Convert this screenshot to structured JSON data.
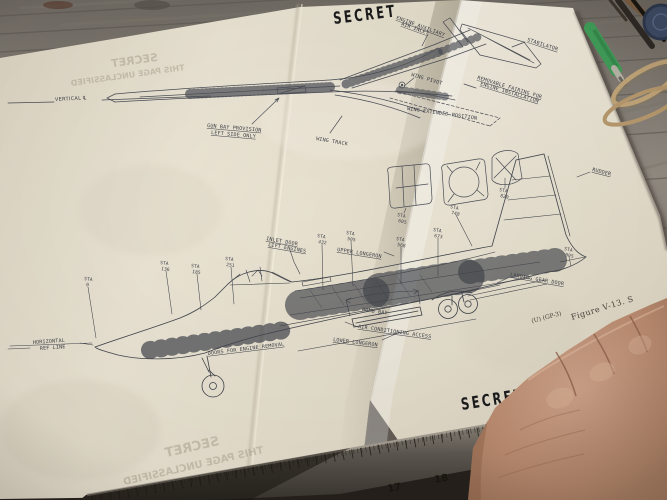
{
  "photo": {
    "stamps": {
      "top": "SECRET",
      "bottom": "SECRET"
    },
    "bleedthrough": {
      "secret": "SECRET",
      "unclassified": "THIS PAGE UNCLASSIFIED"
    },
    "figure": {
      "caption": "Figure V-13. S",
      "code": "(U) (GP-3)"
    },
    "ruler_ticks": [
      "17",
      "18",
      "19"
    ]
  },
  "diagram": {
    "plan": {
      "vertical_cl": "VERTICAL ℄",
      "engine_aux_1": "ENGINE AUXILIARY",
      "engine_aux_2": "AIR INLET",
      "stabilator": "STABILATOR",
      "wing_pivot": "WING PIVOT",
      "wing_extended": "WING EXTENDED POSITION",
      "removable_fairing_1": "REMOVABLE FAIRING FOR",
      "removable_fairing_2": "ENGINE INSTALLATION",
      "gun_bay_1": "GUN BAY PROVISION",
      "gun_bay_2": "LEFT SIDE ONLY",
      "wing_track": "WING TRACK"
    },
    "side": {
      "rudder": "RUDDER",
      "inlet_door_1": "INLET DOOR",
      "inlet_door_2": "LIFT ENGINES",
      "upper_longeron": "UPPER LONGERON",
      "lower_longeron": "LOWER LONGERON",
      "bomb_bay": "BOMB BAY",
      "air_conditioning": "AIR CONDITIONING ACCESS",
      "landing_gear_door": "LANDING GEAR DOOR",
      "doors_engine_removal": "DOORS FOR ENGINE REMOVAL",
      "horizontal_ref_1": "HORIZONTAL",
      "horizontal_ref_2": "REF LINE"
    },
    "stations": [
      {
        "a": "STA",
        "b": "0"
      },
      {
        "a": "STA",
        "b": "136"
      },
      {
        "a": "STA",
        "b": "185"
      },
      {
        "a": "STA",
        "b": "251"
      },
      {
        "a": "STA",
        "b": "432"
      },
      {
        "a": "STA",
        "b": "505"
      },
      {
        "a": "STA",
        "b": "568"
      },
      {
        "a": "STA",
        "b": "605"
      },
      {
        "a": "STA",
        "b": "673"
      },
      {
        "a": "STA",
        "b": "748"
      },
      {
        "a": "STA",
        "b": "820"
      },
      {
        "a": "STA",
        "b": "905"
      }
    ]
  },
  "colors": {
    "paper_left": "#e9e3d3",
    "paper_right": "#f3eee0",
    "ink": "#474a52",
    "stamp": "#1a1a1c",
    "wood": "#8a857c",
    "skin": "#bd8f76",
    "ruler_metal": "#5a554e",
    "pen_green": "#3f9d58",
    "rubber_band": "#c2a578"
  }
}
